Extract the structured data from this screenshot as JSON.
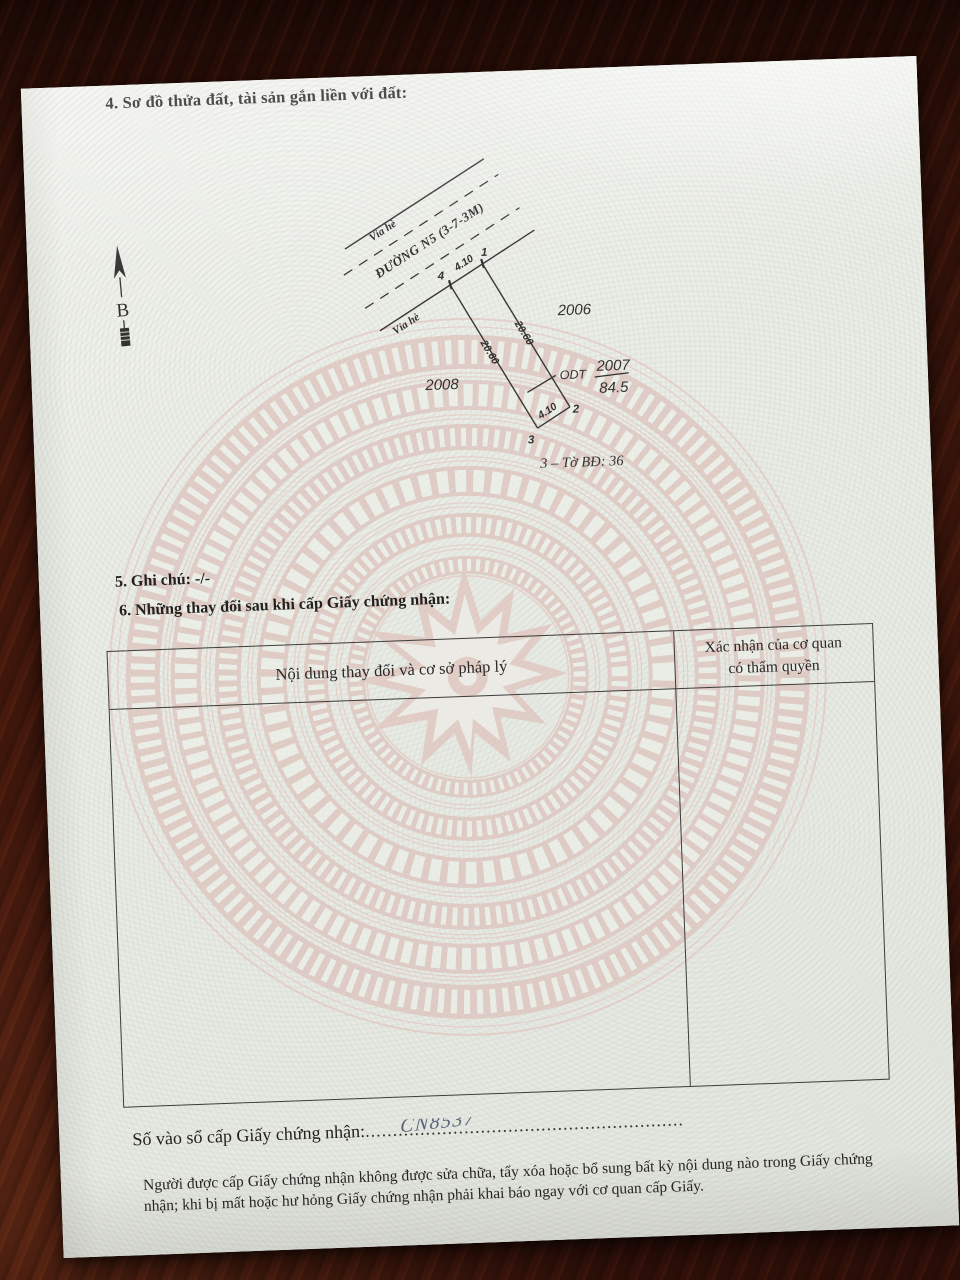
{
  "page": {
    "section4_title": "4. Sơ đồ thửa đất, tài sản gắn liền với đất:",
    "compass": {
      "north_label": "B"
    },
    "diagram": {
      "sidewalk_top_label": "Vỉa hè",
      "street_name": "ĐƯỜNG N5 (3-7-3M)",
      "sidewalk_front_label": "Vỉa hè",
      "corner_4": "4",
      "corner_1": "1",
      "corner_2": "2",
      "corner_3": "3",
      "frontage_length": "4.10",
      "left_side_length": "20.60",
      "right_side_length": "20.60",
      "rear_length": "4.10",
      "land_use_code": "ODT",
      "parcel_number": "2007",
      "parcel_area": "84.5",
      "neighbor_parcel_left": "2008",
      "neighbor_parcel_right": "2006",
      "map_sheet_note": "3 – Tờ BĐ: 36"
    },
    "section5_note": "5. Ghi chú: -/-",
    "section6_title": "6. Những thay đổi sau khi cấp Giấy chứng nhận:",
    "table": {
      "col1_header": "Nội dung thay đổi và cơ sở pháp lý",
      "col2_header_line1": "Xác nhận của cơ quan",
      "col2_header_line2": "có thẩm quyền"
    },
    "registry": {
      "specks": ". .",
      "label": "Số vào sổ cấp Giấy chứng nhận:",
      "dots": "..........................................................",
      "handwritten_number": "CN8537"
    },
    "footer_note": "Người được cấp Giấy chứng nhận không được sửa chữa, tẩy xóa hoặc bổ sung bất kỳ nội dung nào trong Giấy chứng nhận; khi bị mất hoặc hư hỏng Giấy chứng nhận phải khai báo ngay với cơ quan cấp Giấy."
  }
}
